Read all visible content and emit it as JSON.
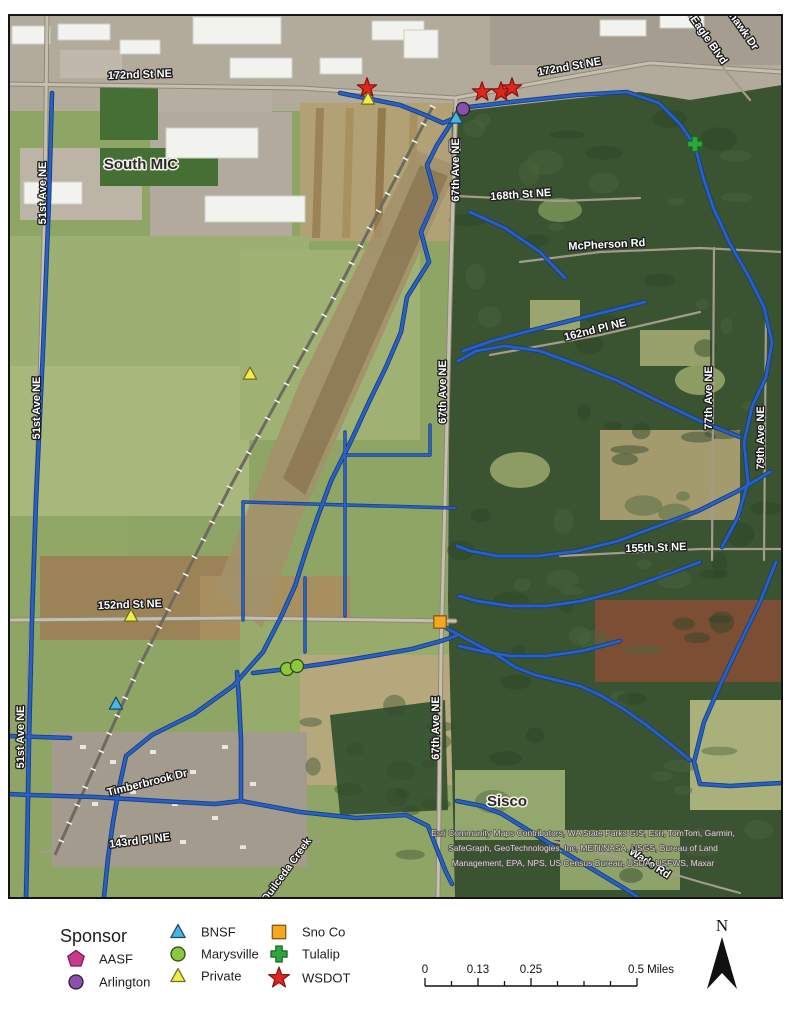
{
  "map": {
    "road_labels": [
      {
        "text": "172nd St NE",
        "x": 140,
        "y": 78,
        "r": -2
      },
      {
        "text": "172nd St NE",
        "x": 570,
        "y": 70,
        "r": -10
      },
      {
        "text": "51st Ave NE",
        "x": 46,
        "y": 193,
        "r": -90
      },
      {
        "text": "67th Ave NE",
        "x": 459,
        "y": 170,
        "r": -90
      },
      {
        "text": "168th St NE",
        "x": 521,
        "y": 198,
        "r": -4
      },
      {
        "text": "McPherson Rd",
        "x": 607,
        "y": 248,
        "r": -3
      },
      {
        "text": "162nd Pl NE",
        "x": 596,
        "y": 333,
        "r": -14
      },
      {
        "text": "67th Ave NE",
        "x": 446,
        "y": 392,
        "r": -90
      },
      {
        "text": "77th Ave NE",
        "x": 712,
        "y": 398,
        "r": -90
      },
      {
        "text": "79th Ave NE",
        "x": 764,
        "y": 438,
        "r": -90
      },
      {
        "text": "155th St NE",
        "x": 656,
        "y": 551,
        "r": -2
      },
      {
        "text": "152nd St NE",
        "x": 130,
        "y": 608,
        "r": -2
      },
      {
        "text": "51st Ave NE",
        "x": 40,
        "y": 408,
        "r": -90
      },
      {
        "text": "51st Ave NE",
        "x": 24,
        "y": 737,
        "r": -90
      },
      {
        "text": "67th Ave NE",
        "x": 439,
        "y": 728,
        "r": -90
      },
      {
        "text": "Timberbrook Dr",
        "x": 148,
        "y": 786,
        "r": -14
      },
      {
        "text": "143rd Pl NE",
        "x": 140,
        "y": 844,
        "r": -7
      },
      {
        "text": "Wade Rd",
        "x": 648,
        "y": 866,
        "r": 33
      },
      {
        "text": "Eagle Blvd",
        "x": 706,
        "y": 42,
        "r": 55
      },
      {
        "text": "hawk Dr",
        "x": 741,
        "y": 33,
        "r": 55
      }
    ],
    "place_labels": [
      {
        "text": "South MIC",
        "x": 141,
        "y": 169
      },
      {
        "text": "Sisco",
        "x": 507,
        "y": 806
      }
    ],
    "creek_labels": [
      {
        "text": "Quilceda Creek",
        "x": 289,
        "y": 872,
        "r": -54
      }
    ],
    "attribution": [
      "Esri Community Maps Contributors, WA State Parks GIS, Esri, TomTom, Garmin,",
      "SafeGraph, GeoTechnologies, Inc, METI/NASA, USGS, Bureau of Land",
      "Management, EPA, NPS, US Census Bureau, USDA, USFWS, Maxar"
    ],
    "markers": [
      {
        "sponsor": "WSDOT",
        "x": 367,
        "y": 88
      },
      {
        "sponsor": "Private",
        "x": 368,
        "y": 99
      },
      {
        "sponsor": "WSDOT",
        "x": 482,
        "y": 92
      },
      {
        "sponsor": "WSDOT",
        "x": 501,
        "y": 92
      },
      {
        "sponsor": "WSDOT",
        "x": 512,
        "y": 88
      },
      {
        "sponsor": "Arlington",
        "x": 463,
        "y": 109
      },
      {
        "sponsor": "BNSF",
        "x": 456,
        "y": 118
      },
      {
        "sponsor": "Tulalip",
        "x": 695,
        "y": 144
      },
      {
        "sponsor": "Private",
        "x": 250,
        "y": 374
      },
      {
        "sponsor": "Private",
        "x": 131,
        "y": 616
      },
      {
        "sponsor": "Sno Co",
        "x": 440,
        "y": 622
      },
      {
        "sponsor": "Marysville",
        "x": 287,
        "y": 669
      },
      {
        "sponsor": "Marysville",
        "x": 297,
        "y": 666
      },
      {
        "sponsor": "BNSF",
        "x": 116,
        "y": 704
      }
    ]
  },
  "legend": {
    "title": "Sponsor",
    "items": [
      {
        "label": "AASF",
        "shape": "pentagon",
        "color": "#c73a8c",
        "border": "#7d1c55",
        "col": 0
      },
      {
        "label": "Arlington",
        "shape": "circle",
        "color": "#8c4fb0",
        "border": "#262626",
        "col": 0
      },
      {
        "label": "BNSF",
        "shape": "triangle",
        "color": "#4ab4e6",
        "border": "#1d4a63",
        "col": 1
      },
      {
        "label": "Marysville",
        "shape": "circle",
        "color": "#8dc63f",
        "border": "#2c4a12",
        "col": 1
      },
      {
        "label": "Private",
        "shape": "triangle",
        "color": "#f3ec4d",
        "border": "#70701e",
        "col": 1
      },
      {
        "label": "Sno Co",
        "shape": "square",
        "color": "#f7a823",
        "border": "#8a5a12",
        "col": 2
      },
      {
        "label": "Tulalip",
        "shape": "cross",
        "color": "#2fa63c",
        "border": "#186a22",
        "col": 2
      },
      {
        "label": "WSDOT",
        "shape": "star",
        "color": "#e0251f",
        "border": "#8a1511",
        "col": 2
      }
    ]
  },
  "scalebar": {
    "labels": [
      {
        "text": "0",
        "frac": 0
      },
      {
        "text": "0.13",
        "frac": 0.25
      },
      {
        "text": "0.25",
        "frac": 0.5
      },
      {
        "text": "0.5 Miles",
        "frac": 1
      }
    ]
  },
  "north": {
    "label": "N"
  },
  "colors": {
    "stream_core": "#2a60c0",
    "stream_casing": "#163e83",
    "map_border": "#141414",
    "forest": "#3a5330",
    "field": "#8fa566"
  }
}
